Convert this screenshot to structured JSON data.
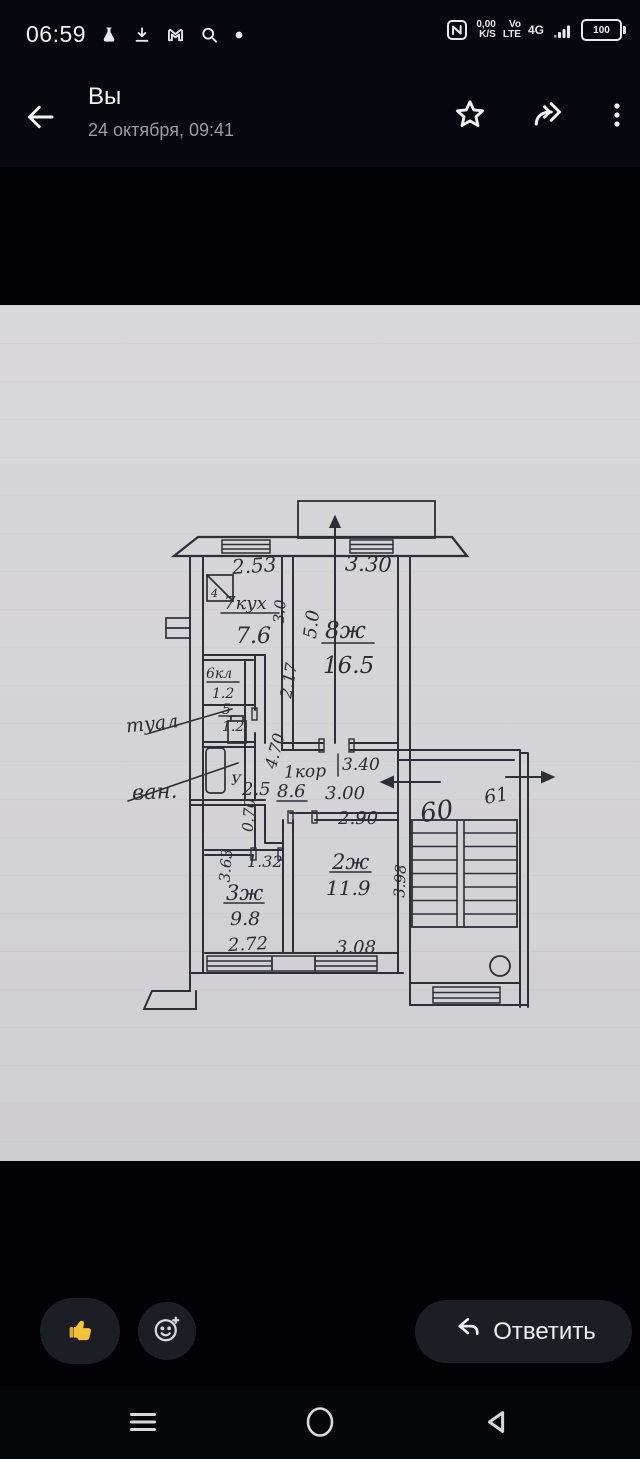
{
  "status_bar": {
    "time": "06:59",
    "net_speed_value": "0,00",
    "net_speed_unit": "K/S",
    "volte_line1": "Vo",
    "volte_line2": "LTE",
    "network_type": "4G",
    "battery_level": "100"
  },
  "header": {
    "title": "Вы",
    "subtitle": "24 октября, 09:41"
  },
  "floorplan": {
    "kitchen_top_width": "2.53",
    "balcony_width": "3.30",
    "rooms": {
      "kitchen": {
        "label": "7кух",
        "area": "7.6",
        "side": "3.0"
      },
      "room8": {
        "label": "8ж",
        "area": "16.5",
        "side": "5.0"
      },
      "closet": {
        "label": "6кл",
        "area": "1.2"
      },
      "toilet": {
        "label": "5",
        "area": "1.2",
        "callout": "туал"
      },
      "bath": {
        "label": "У",
        "area": "2.5",
        "callout": "ван."
      },
      "corridor": {
        "label": "1кор",
        "area": "8.6"
      },
      "room3": {
        "label": "3ж",
        "area": "9.8"
      },
      "room2": {
        "label": "2ж",
        "area": "11.9"
      }
    },
    "dimensions": {
      "hall_upper": "2.17",
      "hall_mid": "4.70",
      "corridor_len1": "3.40",
      "corridor_len2": "3.00",
      "room2_top": "2.90",
      "shaft": "0.70",
      "door_width": "1.32",
      "room3_height": "3.63",
      "room3_width": "2.72",
      "room2_width": "3.08",
      "room2_height": "3.98"
    },
    "stove_mark": "4",
    "apartment_left": "60",
    "apartment_right": "61"
  },
  "footer": {
    "reply_label": "Ответить"
  }
}
